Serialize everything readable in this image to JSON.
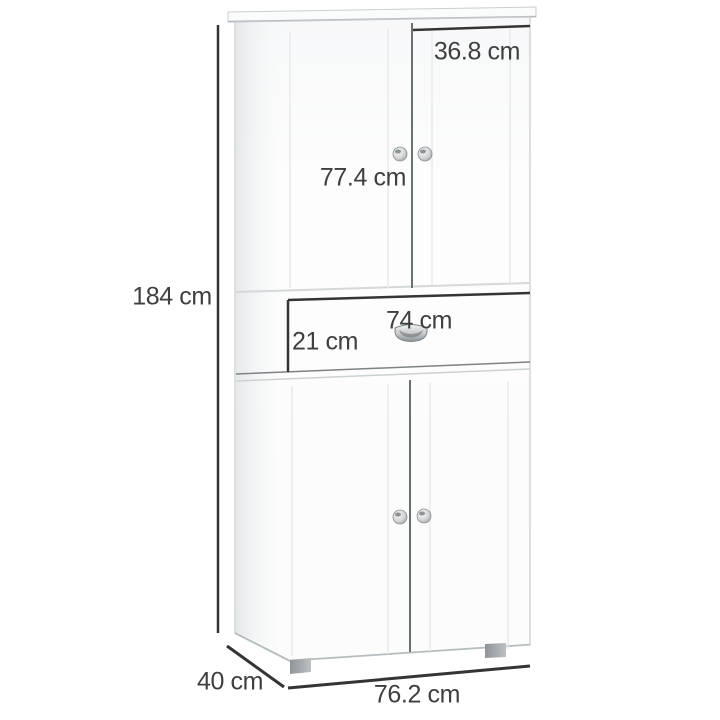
{
  "page": {
    "background": "#ffffff"
  },
  "dimensions": {
    "height": "184 cm",
    "right_door_width": "36.8 cm",
    "upper_door_height": "77.4 cm",
    "drawer_width": "74 cm",
    "drawer_front_height": "21 cm",
    "depth": "40 cm",
    "width": "76.2 cm"
  },
  "hardware": {
    "door_knob_count": 4,
    "drawer_handle": "cup handle",
    "feet_visible": 2
  },
  "colors": {
    "dimension_line": "#343434",
    "label_text": "#3f3f3f",
    "cabinet_edge": "#c6cbce",
    "door_gap": "#6a6f72",
    "groove": "#e7eaeb",
    "foot": "#9da2a5",
    "cabinet_face": "#fdfdfd"
  }
}
